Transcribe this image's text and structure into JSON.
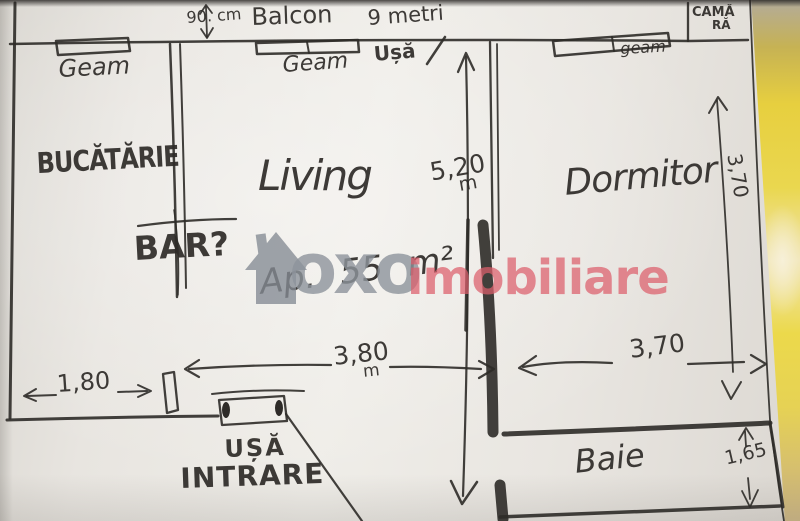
{
  "watermark": {
    "brand": "oxo",
    "suffix": "imobiliare"
  },
  "plan": {
    "balcony_label": "Balcon",
    "balcony_length": "9 metri",
    "balcony_depth": "90. cm",
    "pantry_line1": "CAMĂ",
    "pantry_line2": "RĂ",
    "rooms": {
      "kitchen": "BUCĂTĂRIE",
      "living": "Living",
      "bedroom": "Dormitor",
      "bathroom": "Baie",
      "bar": "BAR?"
    },
    "windows": {
      "kitchen": "Geam",
      "living": "Geam",
      "bedroom": "geam"
    },
    "doors": {
      "balcony": "Ușă",
      "entrance_line1": "UȘĂ",
      "entrance_line2": "INTRARE"
    },
    "area": "Ap. 55 m²",
    "dims": {
      "living_height": {
        "value": "5,20",
        "unit": "m"
      },
      "living_width": {
        "value": "3,80",
        "unit": "m"
      },
      "bedroom_width": {
        "value": "3,70"
      },
      "bedroom_depth": {
        "value": "3,70"
      },
      "hall_width": {
        "value": "1,80"
      },
      "bath_depth": {
        "value": "1,65"
      }
    }
  },
  "colors": {
    "ink": "#2e2b28",
    "paper": "#eceae5",
    "watermark_gray": "#8e949c",
    "watermark_red": "#dd5f6c",
    "blanket_yellow": "#e9d44a"
  }
}
